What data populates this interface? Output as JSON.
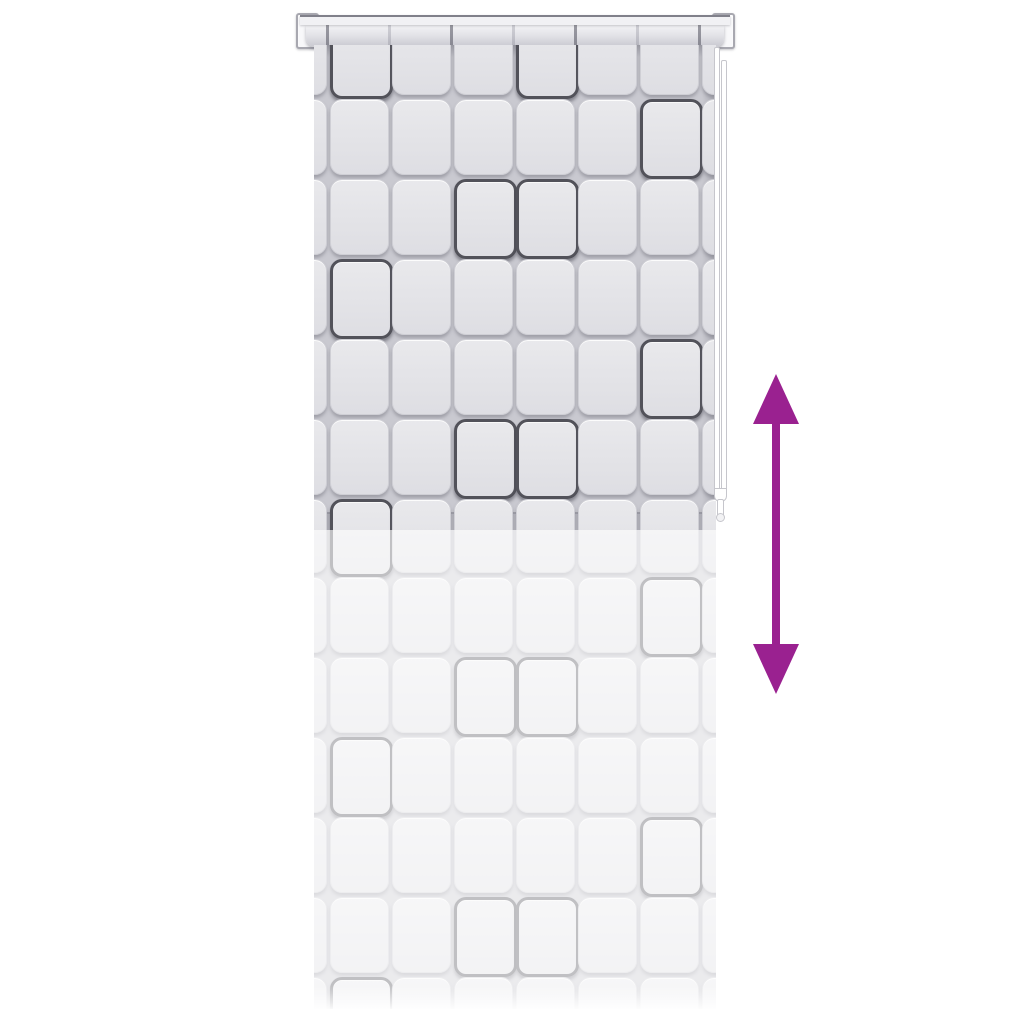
{
  "subject": "shower-roller-blind-product-photo",
  "notes": "square-pattern roller blind with pull cord; purple double arrow indicates adjustable height; no text in image",
  "colors": {
    "background": "#ffffff",
    "arrow": "#9A2190",
    "blind_gap": "#c9c9d0",
    "cell_fill_top": "#e9e9ec",
    "cell_fill_bottom": "#dedee3",
    "cell_border": "#cfcfd5",
    "accent_border": "#52525a",
    "rail_bar": "#f1f1f4",
    "rail_edge": "#80808a",
    "roller_top": "#f4f4f6",
    "roller_bottom": "#c9c9d0",
    "bracket": "#f8f8fa",
    "bracket_border": "#a8a8b0",
    "cord": "#ffffff",
    "cord_edge": "#c6c6cc"
  },
  "pattern": {
    "grid": {
      "col_lefts": [
        -46,
        16,
        78,
        140,
        202,
        264,
        326,
        388
      ],
      "cell_w": 57,
      "cell_h": 74,
      "upper_row_tops": [
        -26,
        54,
        134,
        214,
        294,
        374,
        454
      ],
      "ghost_row_tops": [
        -33,
        47,
        127,
        207,
        287,
        367,
        447
      ]
    },
    "accents_upper": [
      [
        1,
        4
      ],
      [
        6
      ],
      [
        3,
        4
      ],
      [
        1
      ],
      [
        6
      ],
      [
        3,
        4
      ],
      [
        1
      ]
    ],
    "accents_ghost": [
      [
        1
      ],
      [
        6
      ],
      [
        3,
        4
      ],
      [
        1
      ],
      [
        6
      ],
      [
        3,
        4
      ],
      [
        1
      ]
    ],
    "roller_tick_lefts": [
      20,
      82,
      144,
      206,
      268,
      330,
      392
    ]
  },
  "icons": {
    "double_arrow": "up-down-double-arrow-icon"
  }
}
